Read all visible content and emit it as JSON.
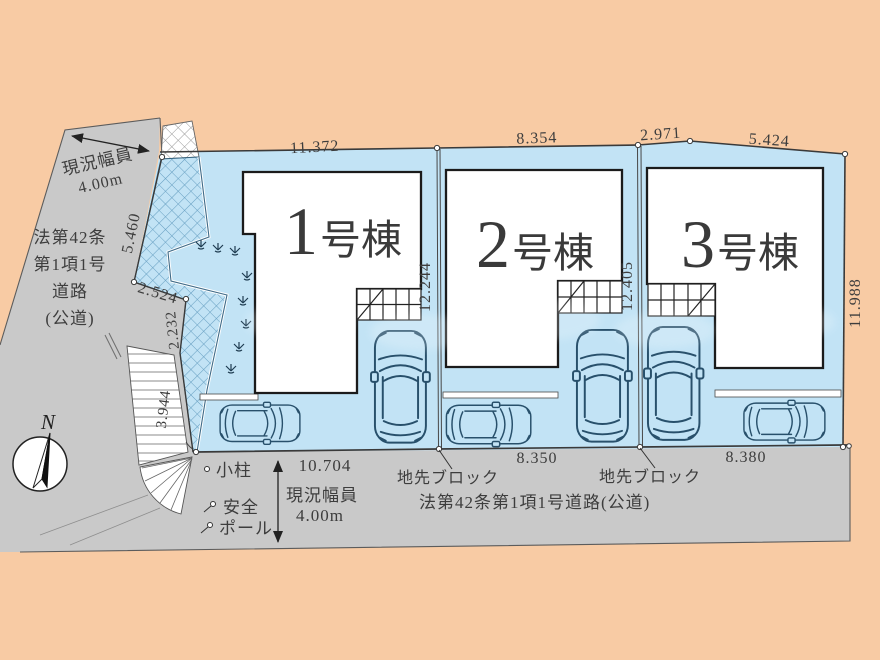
{
  "compass": {
    "label": "N"
  },
  "buildings": [
    {
      "num": "1",
      "suffix": "号棟"
    },
    {
      "num": "2",
      "suffix": "号棟"
    },
    {
      "num": "3",
      "suffix": "号棟"
    }
  ],
  "dims": {
    "top": [
      "11.372",
      "8.354",
      "2.971",
      "5.424"
    ],
    "side": [
      "12.244",
      "12.405",
      "11.988"
    ],
    "bottom": [
      "10.704",
      "8.350",
      "8.380"
    ],
    "left_edge": [
      "5.460",
      "2.524",
      "2.232",
      "3.944"
    ]
  },
  "left_road": {
    "width_line1": "現況幅員",
    "width_line2": "4.00m",
    "name_line1": "法第42条",
    "name_line2": "第1項1号",
    "name_line3": "道路",
    "name_line4": "(公道)"
  },
  "bottom_road": {
    "width_line1": "現況幅員",
    "width_line2": "4.00m",
    "name": "法第42条第1項1号道路(公道)"
  },
  "annotations": {
    "edge_block_left": "地先ブロック",
    "edge_block_right": "地先ブロック",
    "small_pillar": "小柱",
    "safety_line1": "安全",
    "safety_line2": "ポール"
  },
  "colors": {
    "background": "#f8cba4",
    "road": "#c9c9c9",
    "lot": "#c2e3f5",
    "hatch_line": "#68a0c2",
    "building_fill": "#ffffff",
    "building_border": "#1b1b1b",
    "boundary_line": "#3a3a3a",
    "car_line": "#28506b",
    "text": "#3d3d3d"
  }
}
